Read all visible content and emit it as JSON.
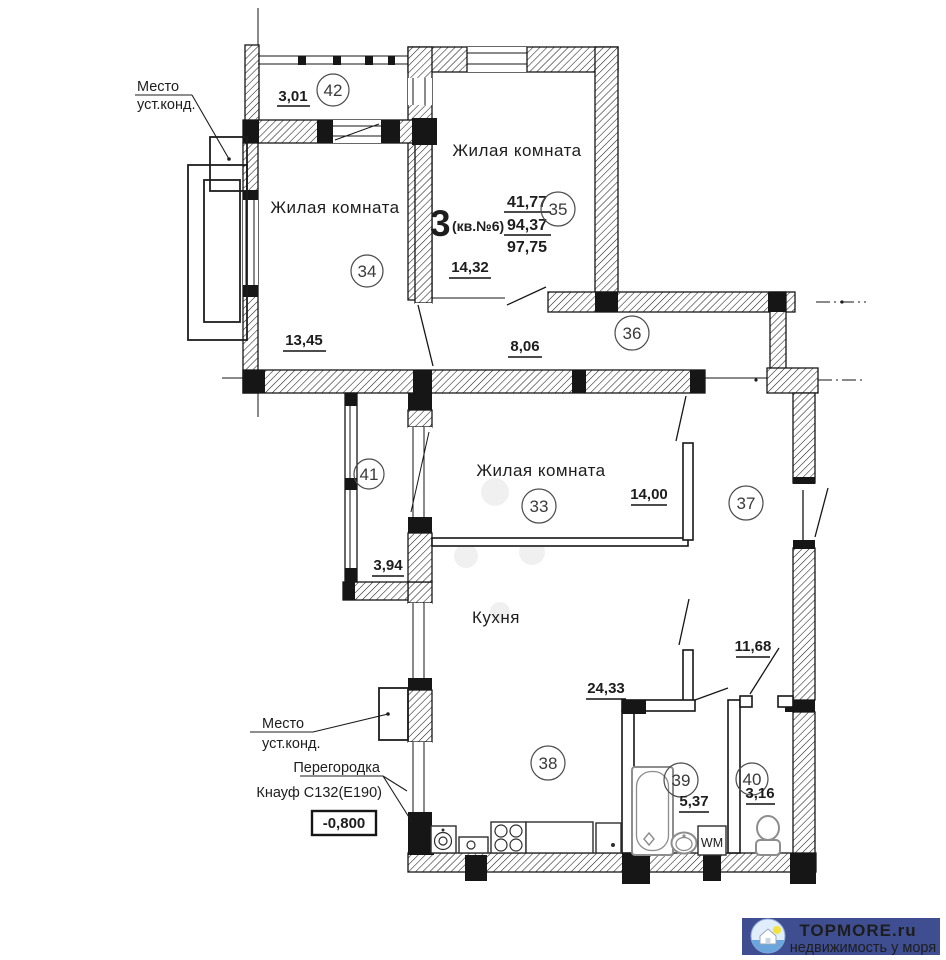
{
  "apartment": {
    "type": "3",
    "suffix": "(кв.№6)",
    "living_area": "41,77",
    "floor_area": "94,37",
    "total_area": "97,75"
  },
  "rooms": {
    "r42": {
      "num": "42",
      "dim": "3,01"
    },
    "r34": {
      "num": "34",
      "label": "Жилая комната",
      "dim": "13,45"
    },
    "r35": {
      "num": "35",
      "label": "Жилая комната",
      "dim": "14,32"
    },
    "r36": {
      "num": "36",
      "dim": "8,06"
    },
    "r41": {
      "num": "41",
      "dim": "3,94"
    },
    "r33": {
      "num": "33",
      "label": "Жилая комната",
      "dim": "14,00"
    },
    "r37": {
      "num": "37",
      "dim": "11,68"
    },
    "r38": {
      "num": "38",
      "label": "Кухня",
      "dim": "24,33"
    },
    "r39": {
      "num": "39",
      "dim": "5,37"
    },
    "r40": {
      "num": "40",
      "dim": "3,16"
    }
  },
  "annotations": {
    "ac_top_line1": "Место",
    "ac_top_line2": "уст.конд.",
    "ac_bottom_line1": "Место",
    "ac_bottom_line2": "уст.конд.",
    "partition_line1": "Перегородка",
    "partition_line2": "Кнауф С132(Е190)",
    "elevation": "-0,800",
    "washing_machine": "WM"
  },
  "logo": {
    "brand": "TOPMORE.ru",
    "tagline": "недвижимость у моря",
    "banner_color": "#3e4e91",
    "brand_color": "#bcc6ee",
    "tagline_color": "#ffffff"
  }
}
